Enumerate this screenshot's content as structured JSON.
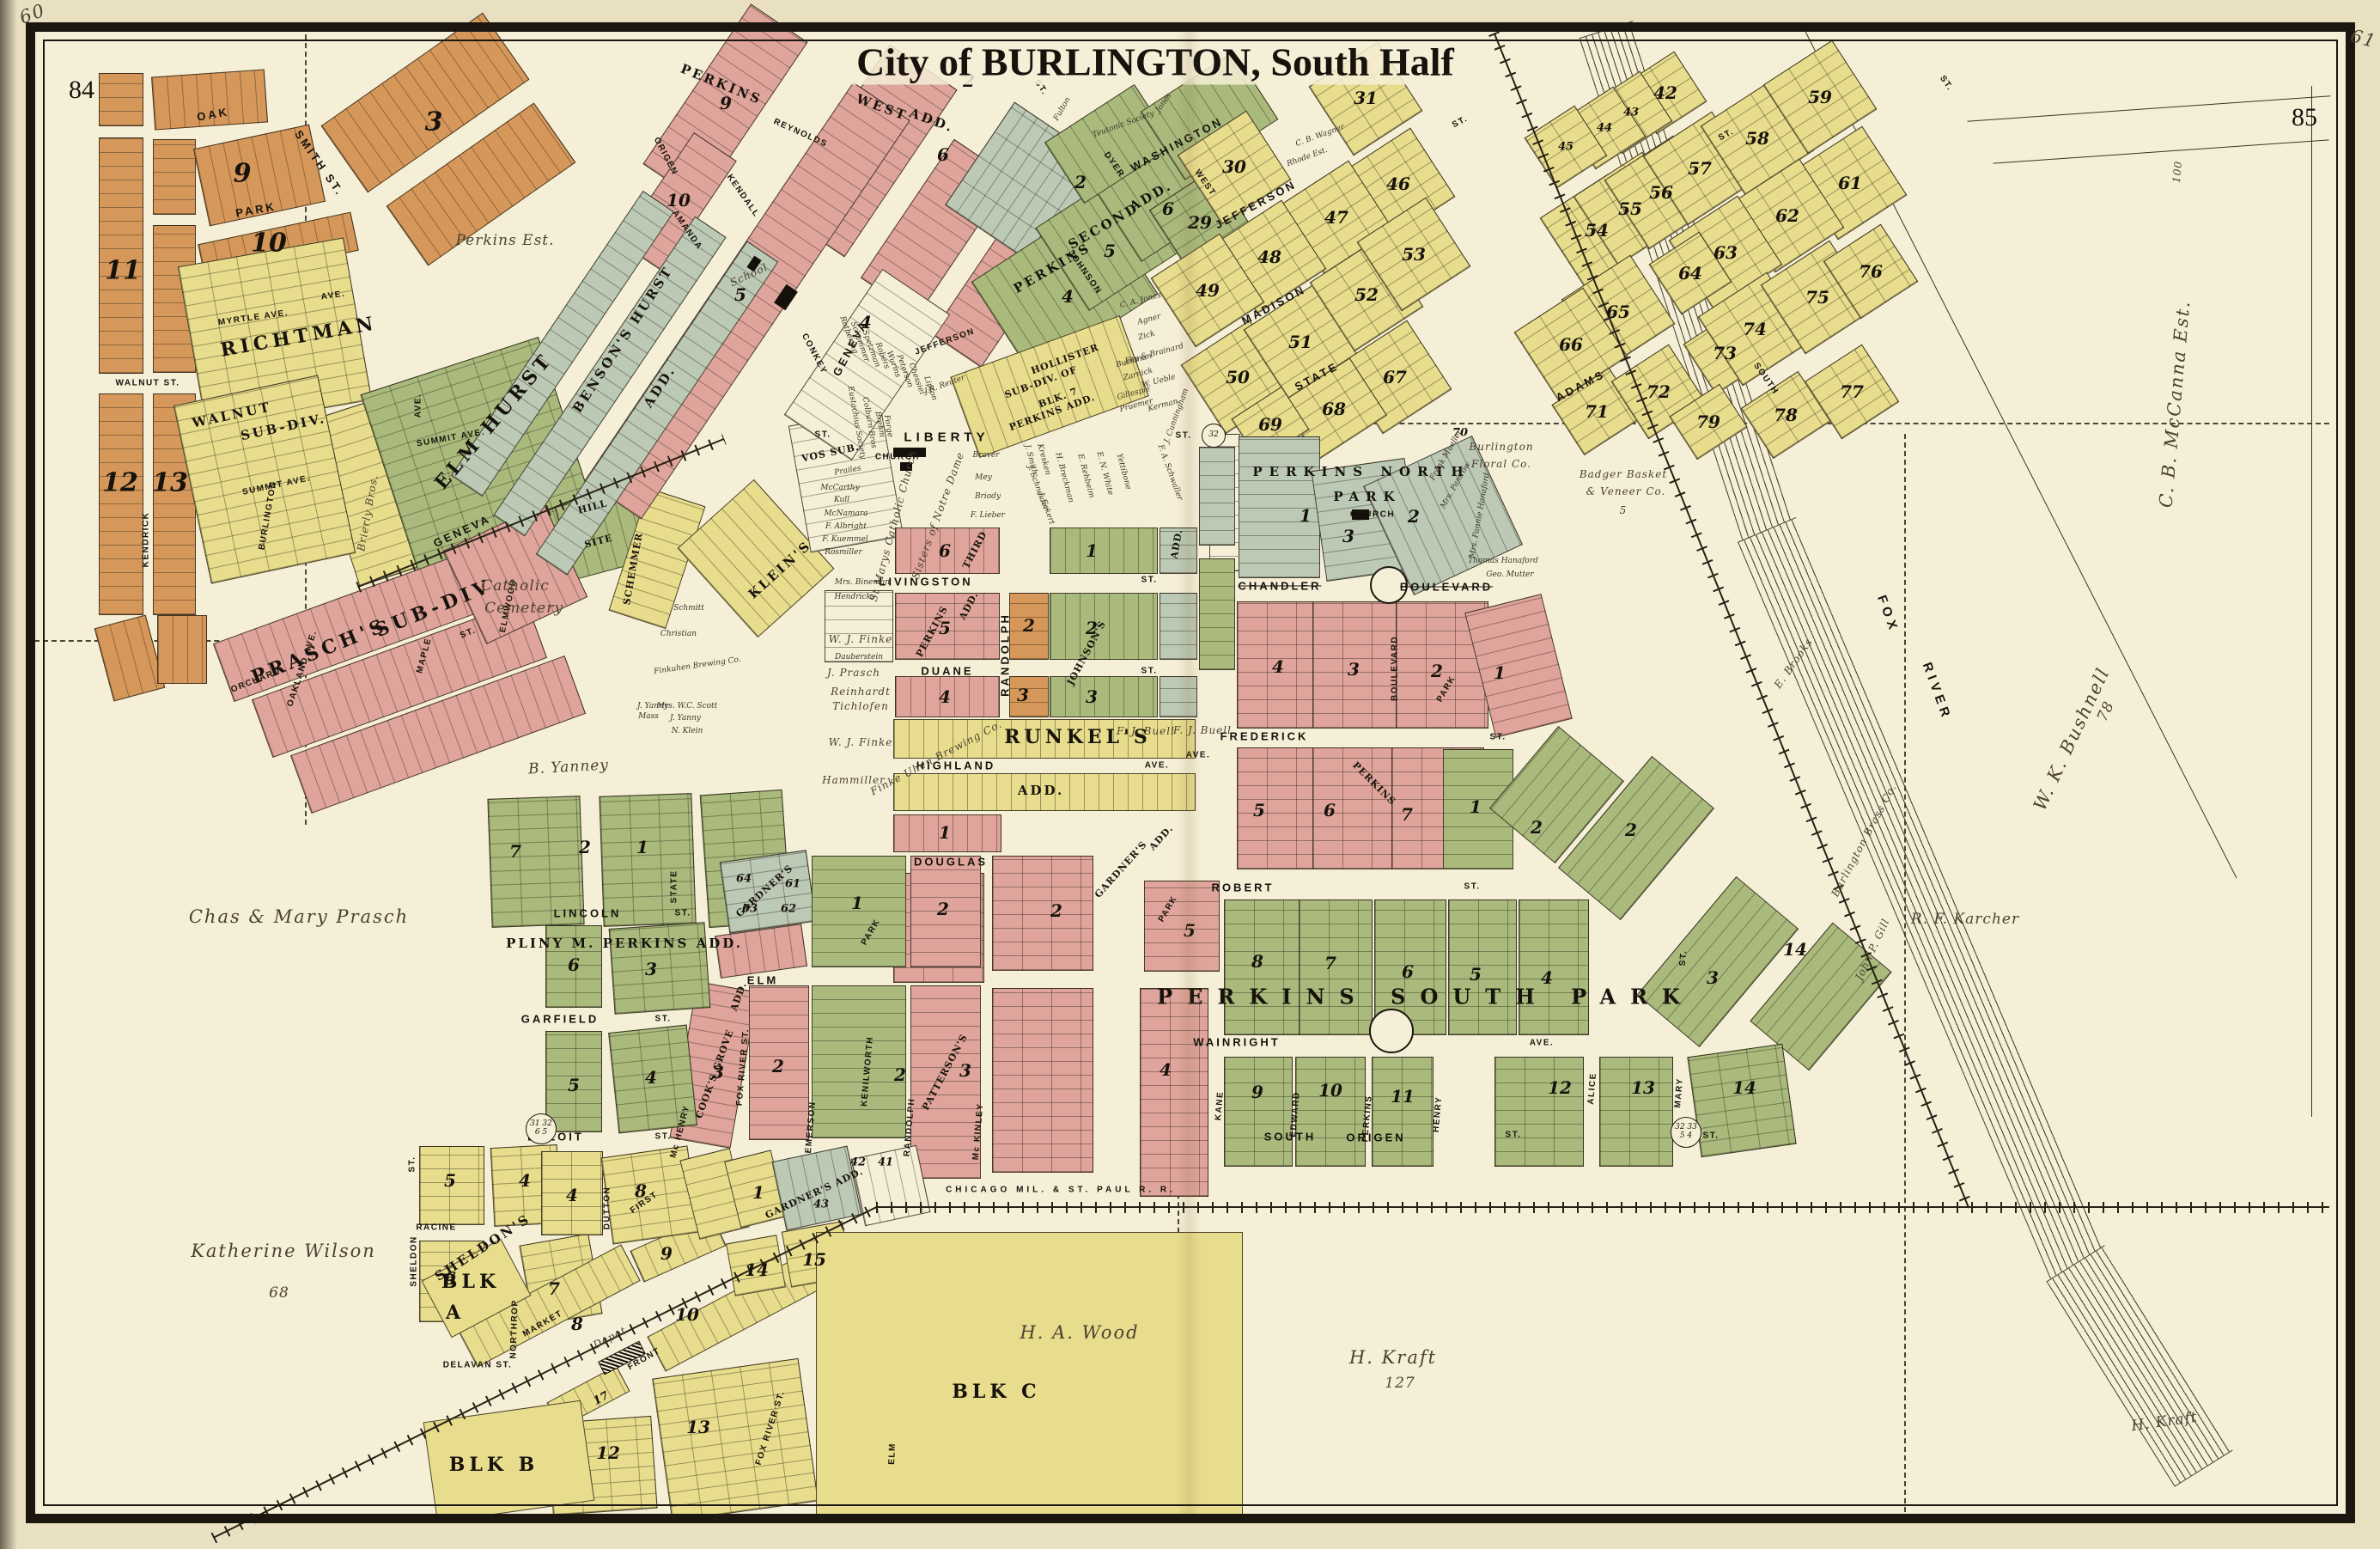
{
  "page": {
    "title": "City of BURLINGTON, South Half",
    "page_left": "84",
    "page_right": "85",
    "corner_left": "60",
    "corner_right": "61"
  },
  "colors": {
    "paper": "#e9e0c2",
    "plate": "#f6efd8",
    "orange": "#d6975a",
    "yellow": "#e8dd8c",
    "pink": "#dfa49b",
    "green": "#a9ba7c",
    "sage": "#bcc9b5",
    "ink": "#1b1610",
    "hand_ink": "#4a4132"
  },
  "river": {
    "word1": "FOX",
    "word2": "RIVER"
  },
  "railroad": {
    "cmsp": "CHICAGO     MIL.    &    ST.  PAUL     R.  R."
  },
  "markers": {
    "beloit_a": "31 32",
    "beloit_b": "6 5",
    "liberty": "32",
    "origen_a": "32 33",
    "origen_b": "5 4"
  },
  "streets": {
    "oak": "OAK",
    "smith_st": "SMITH ST.",
    "park": "PARK",
    "myrtle_ave": "MYRTLE AVE.",
    "ave1": "AVE.",
    "walnut_st": "WALNUT ST.",
    "kendrick": "KENDRICK",
    "summit_ave_w": "SUMMIT AVE.",
    "burlington": "BURLINGTON",
    "summit_ave_e": "SUMMIT AVE.",
    "ave2": "AVE.",
    "geneva_sw": "GENEVA",
    "geneva_ne": "GENEVA",
    "orchard": "ORCHARD",
    "oakland_ave": "OAKLAND AVE.",
    "maple": "MAPLE",
    "elmwood": "ELMWOOD",
    "st_elmwood": "ST.",
    "origen": "ORIGEN",
    "amanda": "AMANDA",
    "kendall": "KENDALL",
    "reynolds": "REYNOLDS",
    "conkey": "CONKEY",
    "dyer": "DYER",
    "washington": "WASHINGTON",
    "west": "WEST",
    "jefferson_ne": "JEFFERSON",
    "jefferson_sw": "JEFFERSON",
    "johnson": "JOHNSON",
    "madison": "MADISON",
    "state_ne": "STATE",
    "adams": "ADAMS",
    "south_ne": "SOUTH",
    "liberty": "LIBERTY",
    "st_liberty_w": "ST.",
    "livingston": "LIVINGSTON",
    "st_livingston": "ST.",
    "duane": "DUANE",
    "st_duane": "ST.",
    "randolph_n": "RANDOLPH",
    "highland": "HIGHLAND",
    "ave_highland": "AVE.",
    "douglas": "DOUGLAS",
    "elm_w": "ELM",
    "lincoln": "LINCOLN",
    "st_lincoln": "ST.",
    "garfield": "GARFIELD",
    "st_garfield": "ST.",
    "beloit": "BELOIT",
    "st_beloit": "ST.",
    "state_s": "STATE",
    "dutton": "DUTTON",
    "mchenry": "Mc HENRY",
    "first": "FIRST",
    "fox_river_n": "FOX RIVER ST.",
    "fox_river_s": "FOX RIVER ST.",
    "kenilworth": "KENILWORTH",
    "emerson": "EMERSON",
    "park_diag": "PARK",
    "park_s": "PARK",
    "randolph_s": "RANDOLPH",
    "mckinley": "Mc KINLEY",
    "kane": "KANE",
    "edward": "EDWARD",
    "perkins_st": "PERKINS",
    "henry": "HENRY",
    "alice": "ALICE",
    "mary": "MARY",
    "st_mary": "ST.",
    "robert": "ROBERT",
    "st_robert": "ST.",
    "wainright": "WAINRIGHT",
    "ave_wainright": "AVE.",
    "south_s": "SOUTH",
    "origen_s": "ORIGEN",
    "st_origen": "ST.",
    "frederick": "FREDERICK",
    "st_frederick": "ST.",
    "chandler": "CHANDLER",
    "boulevard_e": "BOULEVARD",
    "boulevard_v": "BOULEVARD",
    "park_ave": "PARK",
    "sheldon_v": "SHELDON",
    "st_sheldon": "ST.",
    "racine": "RACINE",
    "northrop": "NORTHROP",
    "delavan": "DELAVAN ST.",
    "market": "MARKET",
    "front": "FRONT",
    "elm_s": "ELM",
    "st32": "ST.",
    "ave3": "AVE.",
    "stg1": "ST.",
    "stg2": "ST.",
    "stg3": "ST.",
    "stg4": "ST.",
    "stg5": "ST."
  },
  "subdivisions": {
    "richtman": "RICHTMAN",
    "walnut1": "WALNUT",
    "walnut2": "SUB-DIV.",
    "prasch1": "PRASCH'S",
    "prasch2": "SUB-DIV",
    "elm_hurst": "ELM HURST",
    "bensons": "BENSON'S HURST",
    "bensons_add": "ADD.",
    "pwest1": "PERKINS",
    "pwest2": "WEST",
    "pwest3": "ADD.",
    "psec1": "PERKINS",
    "psec2": "SECOND",
    "psec3": "ADD.",
    "holl1": "HOLLISTER",
    "holl2": "SUB-DIV. OF",
    "holl3": "BLK. 7",
    "holl4": "PERKINS ADD.",
    "vos": "VOS SUB.",
    "kleins": "KLEIN'S",
    "schemmer_s": "SCHEMMER",
    "hill": "HILL",
    "site": "SITE",
    "third": "THIRD",
    "p3add1": "PERKINS",
    "p3add2": "ADD.",
    "johnsons": "JOHNSON'S",
    "johnsons_add": "ADD.",
    "runkels": "RUNKEL'S",
    "runkels_add": "ADD.",
    "gardners": "GARDNER'S",
    "gardners_add": "ADD.",
    "gardners_blk": "GARDNER'S",
    "gardners_s": "GARDNER'S ADD.",
    "cooks": "COOK'S GROVE",
    "cooks_add": "ADD.",
    "pattersons": "PATTERSON'S",
    "pliny": "PLINY M. PERKINS   ADD.",
    "psouth": "PERKINS  SOUTH  PARK",
    "pnorth1": "PERKINS  NORTH",
    "pnorth2": "PARK",
    "sheldons": "SHELDON'S",
    "blk_a1": "BLK",
    "blk_a2": "A",
    "blk_b": "BLK    B",
    "blk_c": "BLK      C",
    "perkins_diag": "PERKINS"
  },
  "owners": {
    "perkins_est": "Perkins Est.",
    "cath1": "Catholic",
    "cath2": "Cemetery",
    "b_yanney": "B. Yanney",
    "chas": "Chas & Mary Prasch",
    "k_wilson": "Katherine Wilson",
    "kw68": "68",
    "brierly": "Brierly Bros.",
    "ha_wood": "H. A. Wood",
    "h_kraft": "H. Kraft",
    "kraft127": "127",
    "h_kraft2": "H. Kraft",
    "karcher": "R. F. Karcher",
    "gill": "John P. Gill",
    "bushnell": "W. K. Bushnell",
    "b78": "78",
    "mccanna": "C. B. McCanna Est.",
    "m100": "100",
    "floral1": "Burlington",
    "floral2": "Floral Co.",
    "badger1": "Badger Basket",
    "badger2": "& Veneer Co.",
    "badger5": "5",
    "brass": "Burlington Brass Co.",
    "brooks": "E. Brooks",
    "finke_uhen": "Finke Uhen Brewing Co.",
    "wj_finke_a": "W. J. Finke",
    "wj_finke_b": "W. J. Finke",
    "fj_buell_a": "F. J. Buell",
    "fj_buell_b": "F. J. Buell",
    "j_prasch": "J. Prasch",
    "reinhardt": "Reinhardt",
    "tichlofen": "Tichlofen",
    "hammiller": "Hammiller",
    "bineman": "Mrs. Bineman",
    "hendricks": "Hendricks",
    "dauberstein": "Dauberstein",
    "st_marys": "St Marys Catholic Church",
    "sisters": "Sisters of Notre Dame",
    "school": "School",
    "church_lib": "CHURCH",
    "church_np": "CHURCH",
    "depot": "Depot",
    "rothering": "Rothering",
    "schemmer_n": "Schemmer",
    "spetzman": "Spetzman",
    "robers": "Robers",
    "wurms": "Wurms",
    "peterson": "Peterson",
    "chessiel": "Chessiel",
    "lipton": "Lipton",
    "reuter": "J.R. Reuter",
    "eustachius": "Eustachius Society",
    "colburn": "Colburn Bros",
    "brehm": "Brehm",
    "forge": "Forge",
    "prailes": "Prailes",
    "mccarthy": "McCarthy",
    "kull": "Kull",
    "mcnamara": "McNamara",
    "albright": "F. Albright",
    "kuemmel": "F. Kuemmel",
    "rosmiller": "Rosmiller",
    "braver": "Braver",
    "mey": "Mey",
    "briody": "Briody",
    "lieber": "F. Lieber",
    "jsmith": "J. Smith",
    "kresken": "Kresken",
    "schneider": "J. Schneider",
    "eckert": "J. Eckert",
    "breckman": "H. Breckman",
    "rehbeim": "E. Rehbeim",
    "white": "E. N. White",
    "yettibone": "Yettibone",
    "schwaller": "F. A. Schwaller",
    "mueller": "Frank Mueller",
    "pamrow": "Mrs. Pamrow",
    "hanaford_f": "Mrs. Fannie Hanaford",
    "hanaford_t": "Thomas Hanaford",
    "mutter": "Geo. Mutter",
    "wagner": "C. B. Wagner",
    "rhode": "Rhode Est.",
    "jones_ca": "C. A. Jones",
    "agner": "Agner",
    "zick": "Zick",
    "fay": "Fay & Brainard",
    "bushman": "Bushman",
    "zarnick": "Zarnick",
    "ueble": "W. Ueble",
    "gillespie": "Gillespie",
    "pruemer": "Pruemer",
    "kerman": "Kerman",
    "cunningham": "J. Cunningham",
    "teutonic": "Teutonic Society",
    "fulton": "Fulton",
    "jones": "Jones",
    "schmitt": "Schmitt",
    "christian": "Christian",
    "finkuhen": "Finkuhen Brewing Co.",
    "jyanny": "J. Yanny",
    "mass": "Mass",
    "scott": "Mrs. W.C. Scott",
    "yanny2": "J. Yanny",
    "nklein": "N. Klein"
  },
  "nums": {
    "tl11": "11",
    "tl9": "9",
    "tl10": "10",
    "tl3": "3",
    "tl12": "12",
    "tl13": "13",
    "pw9": "9",
    "pw10": "10",
    "pw6": "6",
    "pw2": "2",
    "pw5": "5",
    "pw4": "4",
    "ps4": "4",
    "ps5": "5",
    "ps6": "6",
    "ps2": "2",
    "y29": "29",
    "y30": "30",
    "y31": "31",
    "y46": "46",
    "y47": "47",
    "y48": "48",
    "y49": "49",
    "y50": "50",
    "y51": "51",
    "y52": "52",
    "y53": "53",
    "y67": "67",
    "y68": "68",
    "y69": "69",
    "y70": "70",
    "y42": "42",
    "y43": "43",
    "y44": "44",
    "y45": "45",
    "y54": "54",
    "y55": "55",
    "y56": "56",
    "y57": "57",
    "y58": "58",
    "y59": "59",
    "y61": "61",
    "y62": "62",
    "y63": "63",
    "y64": "64",
    "y65": "65",
    "y66": "66",
    "y71": "71",
    "y72": "72",
    "y73": "73",
    "y74": "74",
    "y75": "75",
    "y76": "76",
    "y77": "77",
    "y78": "78",
    "y79": "79",
    "np1": "1",
    "np2": "2",
    "np3": "3",
    "ch1": "1",
    "ch2": "2",
    "ch3": "3",
    "ch4": "4",
    "fr5": "5",
    "fr6": "6",
    "fr7": "7",
    "frg1": "1",
    "frg2": "2",
    "ro8": "8",
    "ro7": "7",
    "ro6": "6",
    "ro5": "5",
    "ro4": "4",
    "rod2": "2",
    "rod3": "3",
    "wa9": "9",
    "wa10": "10",
    "wa11": "11",
    "wa12": "12",
    "wa13": "13",
    "wa14": "14",
    "ea14": "14",
    "jo1": "1",
    "jo2": "2",
    "jo3": "3",
    "p36": "6",
    "p35": "5",
    "p34": "4",
    "or2": "2",
    "or3": "3",
    "rk1": "1",
    "g61": "61",
    "g62": "62",
    "g63": "63",
    "g64": "64",
    "ke1": "1",
    "ke2": "2",
    "pa2": "2",
    "pa3": "3",
    "cg3": "3",
    "fx2": "2",
    "mk2": "2",
    "pk5": "5",
    "pk4": "4",
    "pl6": "6",
    "pl3": "3",
    "pl5": "5",
    "pl4": "4",
    "sh5": "5",
    "sh4": "4",
    "sh6": "6",
    "sh7": "7",
    "sh8": "8",
    "sh9": "9",
    "sh10": "10",
    "sh12": "12",
    "sh13": "13",
    "sh14": "14",
    "sh15": "15",
    "sh17": "17",
    "du4": "4",
    "du8": "8",
    "du1": "1",
    "ga43": "43",
    "ga42": "42",
    "ga41": "41",
    "by7": "7",
    "by2": "2",
    "by1": "1"
  }
}
